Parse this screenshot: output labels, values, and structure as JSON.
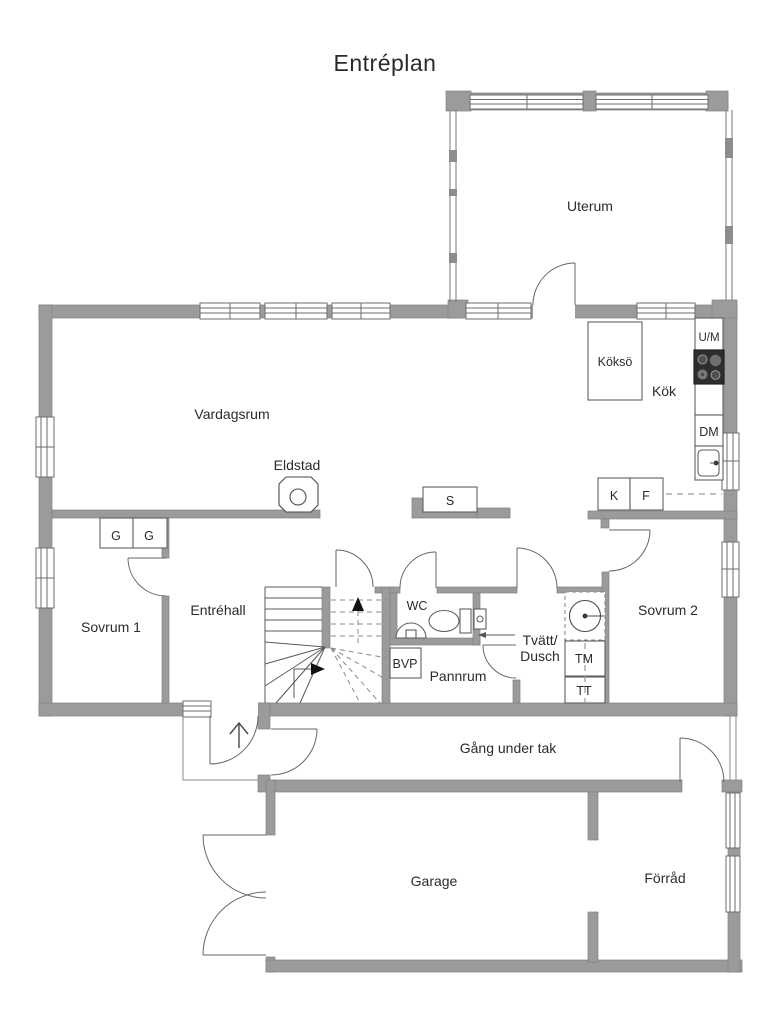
{
  "title": "Entréplan",
  "colors": {
    "wall": "#9b9b9b",
    "line": "#555555",
    "text": "#2b2b2b"
  },
  "rooms": {
    "uterum": "Uterum",
    "vardagsrum": "Vardagsrum",
    "entrehall": "Entréhall",
    "sovrum1": "Sovrum 1",
    "sovrum2": "Sovrum 2",
    "wc": "WC",
    "pannrum": "Pannrum",
    "tvatt_line1": "Tvätt/",
    "tvatt_line2": "Dusch",
    "kok": "Kök",
    "gang_under_tak": "Gång under tak",
    "garage": "Garage",
    "forrad": "Förråd"
  },
  "fixtures": {
    "eldstad": "Eldstad",
    "koksoe": "Köksö",
    "um": "U/M",
    "dm": "DM",
    "kyl": "K",
    "frys": "F",
    "skorsten": "S",
    "garderob1": "G",
    "garderob2": "G",
    "bvp": "BVP",
    "tm": "TM",
    "tt": "TT"
  }
}
